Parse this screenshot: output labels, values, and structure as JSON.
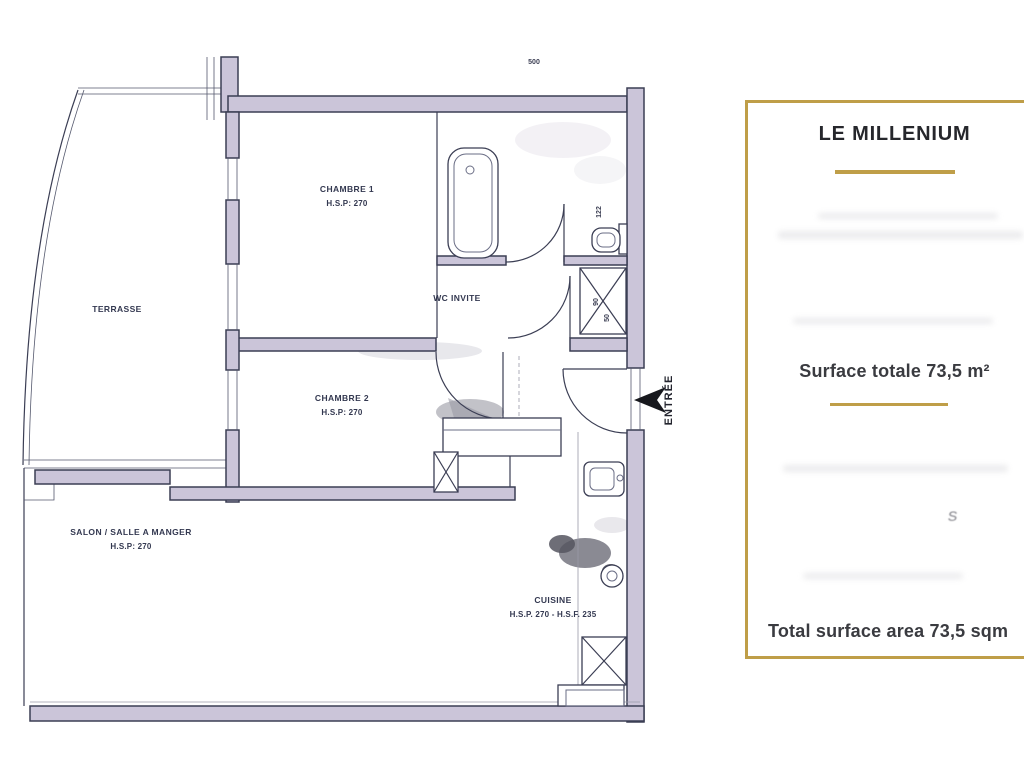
{
  "colors": {
    "gold_accent": "#bf9e48",
    "wall_fill": "#cbc5d9",
    "wall_line": "#3b3e54",
    "plan_text": "#333850",
    "panel_text": "#3a3b40"
  },
  "info_panel": {
    "title": "LE MILLENIUM",
    "surface_total_fr": "Surface totale 73,5 m²",
    "surface_total_en": "Total surface area 73,5 sqm",
    "stray_mark": "S"
  },
  "floor_plan": {
    "labels": {
      "terrasse": "TERRASSE",
      "chambre1": "CHAMBRE 1",
      "chambre1_hsp": "H.S.P: 270",
      "wc": "WC INVITE",
      "chambre2": "CHAMBRE 2",
      "chambre2_hsp": "H.S.P: 270",
      "salon": "SALON / SALLE A MANGER",
      "salon_hsp": "H.S.P: 270",
      "cuisine": "CUISINE",
      "cuisine_hsp": "H.S.P. 270 - H.S.F. 235",
      "entree": "ENTRÉE"
    },
    "dimensions": {
      "top_width": "500",
      "door_width": "122",
      "shaft_a": "90",
      "shaft_b": "50"
    }
  }
}
